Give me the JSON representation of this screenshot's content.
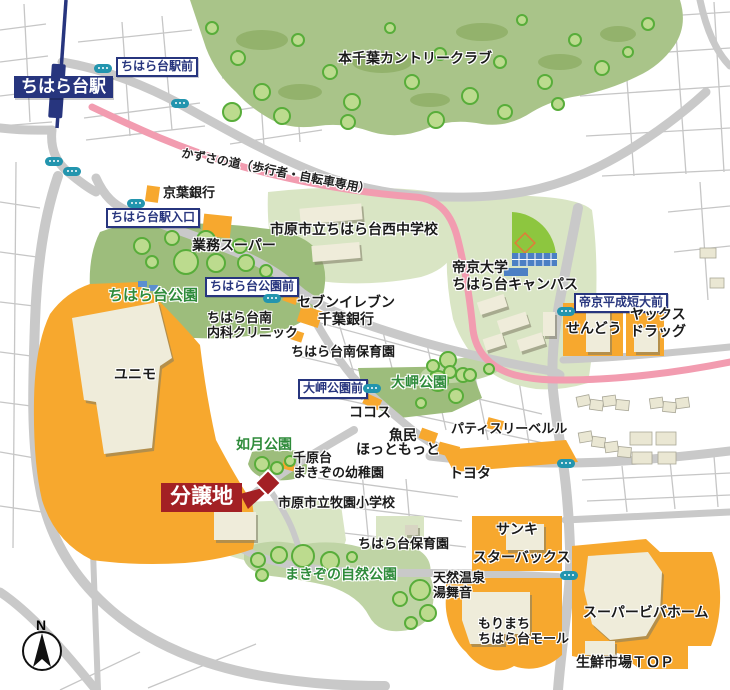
{
  "colors": {
    "navy": "#27357e",
    "bus_teal": "#2395ae",
    "pink_road": "#f29cb0",
    "commercial_orange": "#f7a82e",
    "lot_red": "#a32024",
    "park_green": "#9dbd7c",
    "school_green": "#d9e5c4",
    "forest_green": "#a9c489",
    "nature_green": "#bfd4a5",
    "road_grey": "#c9c9c9",
    "building_cream": "#efecda",
    "park_text_green": "#2e8b3a"
  },
  "compass": {
    "label": "N"
  },
  "labels": [
    {
      "name": "station-name-label",
      "type": "station",
      "text": "ちはら台駅",
      "x": 14,
      "y": 76,
      "fs": 17
    },
    {
      "name": "bus-label-chiharadai-ekimae",
      "type": "stop",
      "text": "ちはら台駅前",
      "x": 116,
      "y": 57,
      "fs": 12
    },
    {
      "name": "honchiba-country-club-label",
      "type": "place",
      "text": "本千葉カントリークラブ",
      "x": 338,
      "y": 50,
      "fs": 14
    },
    {
      "name": "kazusa-road-label",
      "type": "road",
      "text": "かずさの道（歩行者・自転車専用）",
      "x": 183,
      "y": 146,
      "fs": 12,
      "rot": 11
    },
    {
      "name": "keiyo-bank-label",
      "type": "place",
      "text": "京葉銀行",
      "x": 163,
      "y": 185,
      "fs": 13
    },
    {
      "name": "bus-label-eki-iriguchi",
      "type": "stop",
      "text": "ちはら台駅入口",
      "x": 106,
      "y": 208,
      "fs": 12
    },
    {
      "name": "gyomu-super-label",
      "type": "place",
      "text": "業務スーパー",
      "x": 192,
      "y": 237,
      "fs": 14
    },
    {
      "name": "nishi-junior-high-label",
      "type": "place",
      "text": "市原市立ちはら台西中学校",
      "x": 270,
      "y": 221,
      "fs": 14
    },
    {
      "name": "chiharadai-park-label",
      "type": "park",
      "text": "ちはら台公園",
      "x": 108,
      "y": 287,
      "fs": 15
    },
    {
      "name": "bus-label-koen-mae",
      "type": "stop",
      "text": "ちはら台公園前",
      "x": 205,
      "y": 277,
      "fs": 12
    },
    {
      "name": "seven-eleven-label",
      "type": "place",
      "text": "セブンイレブン",
      "x": 297,
      "y": 294,
      "fs": 14
    },
    {
      "name": "chiba-bank-label",
      "type": "place",
      "text": "千葉銀行",
      "x": 318,
      "y": 311,
      "fs": 14
    },
    {
      "name": "naika-clinic-label",
      "type": "place",
      "text": "ちはら台南\n内科クリニック",
      "x": 207,
      "y": 310,
      "fs": 13
    },
    {
      "name": "minami-hoikuen-label",
      "type": "place",
      "text": "ちはら台南保育園",
      "x": 291,
      "y": 344,
      "fs": 13
    },
    {
      "name": "teikyo-campus-label",
      "type": "place",
      "text": "帝京大学\nちはら台キャンパス",
      "x": 452,
      "y": 259,
      "fs": 14
    },
    {
      "name": "bus-label-tandai-mae",
      "type": "stop",
      "text": "帝京平成短大前",
      "x": 574,
      "y": 293,
      "fs": 12
    },
    {
      "name": "sendo-label",
      "type": "place",
      "text": "せんどう",
      "x": 566,
      "y": 320,
      "fs": 14
    },
    {
      "name": "yacks-drug-label",
      "type": "place",
      "text": "ヤックス\nドラッグ",
      "x": 630,
      "y": 306,
      "fs": 14
    },
    {
      "name": "omisaki-park-label",
      "type": "park",
      "text": "大岬公園",
      "x": 391,
      "y": 374,
      "fs": 14
    },
    {
      "name": "bus-label-omisaki-mae",
      "type": "stop",
      "text": "大岬公園前",
      "x": 298,
      "y": 379,
      "fs": 12
    },
    {
      "name": "cocos-label",
      "type": "place",
      "text": "ココス",
      "x": 349,
      "y": 404,
      "fs": 14
    },
    {
      "name": "uotami-label",
      "type": "place",
      "text": "魚民",
      "x": 389,
      "y": 427,
      "fs": 14
    },
    {
      "name": "hotto-motto-label",
      "type": "place",
      "text": "ほっともっと",
      "x": 356,
      "y": 441,
      "fs": 14
    },
    {
      "name": "patisserie-belle-label",
      "type": "place",
      "text": "パティスリーベルル",
      "x": 451,
      "y": 421,
      "fs": 13
    },
    {
      "name": "toyota-label",
      "type": "place",
      "text": "トヨタ",
      "x": 449,
      "y": 465,
      "fs": 14
    },
    {
      "name": "kisaragi-park-label",
      "type": "park",
      "text": "如月公園",
      "x": 236,
      "y": 436,
      "fs": 14
    },
    {
      "name": "makizono-yochien-label",
      "type": "place",
      "text": "千原台\nまきぞの幼稚園",
      "x": 293,
      "y": 450,
      "fs": 13
    },
    {
      "name": "lot-label",
      "type": "lot",
      "text": "分譲地",
      "x": 161,
      "y": 483,
      "fs": 21
    },
    {
      "name": "makizono-elementary-label",
      "type": "place",
      "text": "市原市立牧園小学校",
      "x": 278,
      "y": 495,
      "fs": 13
    },
    {
      "name": "chiharadai-hoikuen-label",
      "type": "place",
      "text": "ちはら台保育園",
      "x": 358,
      "y": 536,
      "fs": 13
    },
    {
      "name": "sanki-label",
      "type": "place",
      "text": "サンキ",
      "x": 496,
      "y": 521,
      "fs": 14
    },
    {
      "name": "starbucks-label",
      "type": "place",
      "text": "スターバックス",
      "x": 473,
      "y": 549,
      "fs": 14
    },
    {
      "name": "makizono-nature-park-label",
      "type": "park",
      "text": "まきぞの自然公園",
      "x": 285,
      "y": 566,
      "fs": 14
    },
    {
      "name": "onsen-yubune-label",
      "type": "place",
      "text": "天然温泉\n湯舞音",
      "x": 433,
      "y": 570,
      "fs": 13
    },
    {
      "name": "morimachi-mall-label",
      "type": "place",
      "text": "もりまち\nちはら台モール",
      "x": 478,
      "y": 616,
      "fs": 13
    },
    {
      "name": "super-viva-home-label",
      "type": "place",
      "text": "スーパービバホーム",
      "x": 583,
      "y": 604,
      "fs": 14
    },
    {
      "name": "top-market-label",
      "type": "place",
      "text": "生鮮市場ＴＯＰ",
      "x": 576,
      "y": 654,
      "fs": 14
    },
    {
      "name": "unimo-label",
      "type": "place",
      "text": "ユニモ",
      "x": 114,
      "y": 366,
      "fs": 14
    }
  ],
  "bus_stops": [
    {
      "x": 103,
      "y": 68
    },
    {
      "x": 180,
      "y": 103
    },
    {
      "x": 54,
      "y": 161
    },
    {
      "x": 72,
      "y": 171
    },
    {
      "x": 136,
      "y": 203
    },
    {
      "x": 272,
      "y": 298
    },
    {
      "x": 372,
      "y": 388
    },
    {
      "x": 566,
      "y": 311
    },
    {
      "x": 566,
      "y": 463
    },
    {
      "x": 569,
      "y": 575
    }
  ]
}
